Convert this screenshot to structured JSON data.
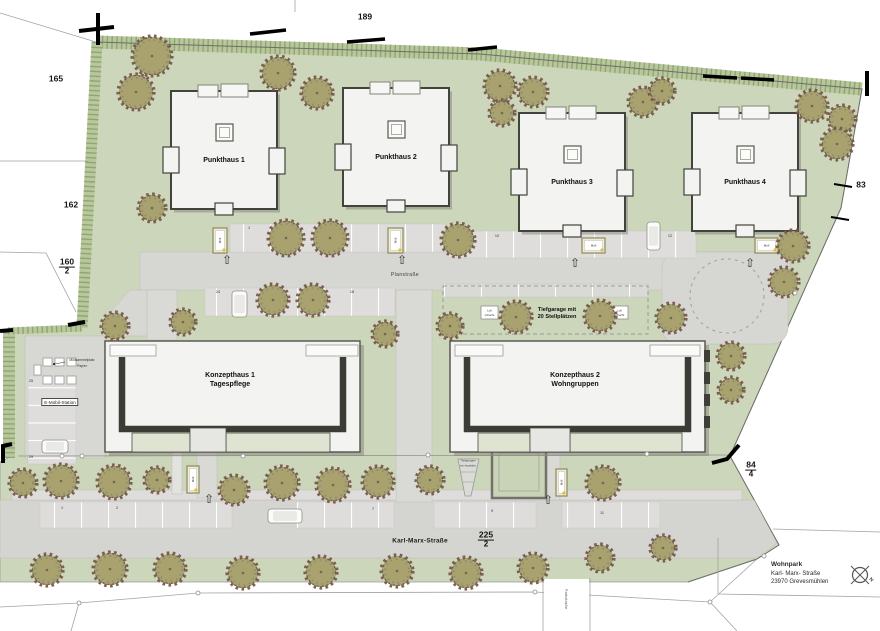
{
  "labels": {
    "planstrasse": "Planstraße",
    "karl_marx_strasse": "Karl-Marx-Straße",
    "side_street": "Parkstraße",
    "muell": "Müll",
    "compass_n": "N",
    "entrance_arrow": "⇧"
  },
  "buildings": {
    "punkthaus": [
      {
        "label": "Punkthaus 1",
        "x": 171,
        "y": 91
      },
      {
        "label": "Punkthaus 2",
        "x": 343,
        "y": 88
      },
      {
        "label": "Punkthaus 3",
        "x": 519,
        "y": 113
      },
      {
        "label": "Punkthaus 4",
        "x": 692,
        "y": 113
      }
    ],
    "konzepthaus": [
      {
        "label": "Konzepthaus 1",
        "subtitle": "Tagespflege"
      },
      {
        "label": "Konzepthaus 2",
        "subtitle": "Wohngruppen"
      }
    ]
  },
  "garage": {
    "line1": "Tiefgarage mit",
    "line2": "20 Stellplätzen",
    "shaft_line1": "Luft",
    "shaft_line2": "schacht",
    "ramp_line1": "Tiefgaragen",
    "ramp_line2": "ein-/ausfahrt"
  },
  "emobil": {
    "station": "E-Mobil-Station",
    "waste_line1": "Müllsammelplatz",
    "waste_line2": "Papier"
  },
  "address": {
    "name": "Wohnpark",
    "street": "Karl- Marx- Straße",
    "city": "23970 Grevesmühlen"
  },
  "parcels": [
    {
      "num": "189",
      "x": 365,
      "y": 17
    },
    {
      "num": "165",
      "x": 56,
      "y": 79
    },
    {
      "num": "162",
      "x": 71,
      "y": 205
    },
    {
      "num": "160",
      "den": "2",
      "x": 67,
      "y": 267
    },
    {
      "num": "83",
      "x": 861,
      "y": 185
    },
    {
      "num": "84",
      "den": "4",
      "x": 751,
      "y": 470
    },
    {
      "num": "225",
      "den": "2",
      "x": 486,
      "y": 540
    }
  ],
  "parking_numbers": [
    {
      "n": "1",
      "x": 249,
      "y": 228
    },
    {
      "n": "10",
      "x": 497,
      "y": 236
    },
    {
      "n": "12",
      "x": 670,
      "y": 236
    },
    {
      "n": "24",
      "x": 218,
      "y": 292
    },
    {
      "n": "18",
      "x": 352,
      "y": 292
    },
    {
      "n": "1",
      "x": 62,
      "y": 508
    },
    {
      "n": "2",
      "x": 117,
      "y": 508
    },
    {
      "n": "7",
      "x": 373,
      "y": 509
    },
    {
      "n": "9",
      "x": 492,
      "y": 511
    },
    {
      "n": "11",
      "x": 602,
      "y": 513
    },
    {
      "n": "25",
      "x": 31,
      "y": 381
    },
    {
      "n": "29",
      "x": 31,
      "y": 457
    }
  ],
  "colors": {
    "site_green": "#ccd6bb",
    "hedge_green": "#b9c79d",
    "hedge_hatch": "#90a573",
    "road_gray": "#d6d6d3",
    "bay_gray": "#dedddb",
    "building_fill": "#f3f3f1",
    "building_edge": "#43433d",
    "tree_fill": "#a9a26e",
    "tree_speckle": "#7d5549",
    "court_green": "#c9d3b6",
    "marker_black": "#000000"
  },
  "map": {
    "trees": [
      [
        152,
        56,
        19
      ],
      [
        136,
        92,
        17
      ],
      [
        278,
        73,
        16
      ],
      [
        317,
        93,
        15
      ],
      [
        500,
        86,
        15
      ],
      [
        533,
        92,
        14
      ],
      [
        502,
        113,
        12
      ],
      [
        643,
        102,
        14
      ],
      [
        662,
        91,
        12
      ],
      [
        812,
        106,
        15
      ],
      [
        842,
        119,
        13
      ],
      [
        837,
        144,
        15
      ],
      [
        152,
        208,
        13
      ],
      [
        115,
        326,
        13
      ],
      [
        183,
        322,
        12
      ],
      [
        286,
        238,
        17
      ],
      [
        330,
        238,
        17
      ],
      [
        458,
        240,
        16
      ],
      [
        793,
        246,
        15
      ],
      [
        273,
        300,
        15
      ],
      [
        313,
        300,
        15
      ],
      [
        385,
        334,
        12
      ],
      [
        450,
        326,
        12
      ],
      [
        516,
        317,
        15
      ],
      [
        600,
        316,
        15
      ],
      [
        671,
        318,
        14
      ],
      [
        731,
        356,
        13
      ],
      [
        731,
        390,
        12
      ],
      [
        784,
        282,
        14
      ],
      [
        603,
        483,
        16
      ],
      [
        23,
        483,
        13
      ],
      [
        61,
        481,
        16
      ],
      [
        114,
        482,
        16
      ],
      [
        157,
        480,
        12
      ],
      [
        234,
        490,
        14
      ],
      [
        282,
        483,
        16
      ],
      [
        333,
        485,
        16
      ],
      [
        378,
        482,
        15
      ],
      [
        430,
        480,
        13
      ],
      [
        47,
        570,
        15
      ],
      [
        110,
        569,
        16
      ],
      [
        170,
        569,
        15
      ],
      [
        243,
        573,
        15
      ],
      [
        321,
        572,
        15
      ],
      [
        397,
        571,
        15
      ],
      [
        466,
        573,
        15
      ],
      [
        533,
        568,
        14
      ],
      [
        600,
        558,
        13
      ],
      [
        663,
        548,
        12
      ]
    ],
    "cars": [
      {
        "x": 647,
        "y": 222,
        "w": 13,
        "h": 28
      },
      {
        "x": 232,
        "y": 291,
        "w": 15,
        "h": 26
      },
      {
        "x": 42,
        "y": 440,
        "w": 26,
        "h": 13
      },
      {
        "x": 268,
        "y": 509,
        "w": 34,
        "h": 14
      }
    ],
    "muell_boxes": [
      {
        "x": 213,
        "y": 228,
        "w": 14,
        "h": 25,
        "v": true
      },
      {
        "x": 388,
        "y": 228,
        "w": 15,
        "h": 25,
        "v": true
      },
      {
        "x": 582,
        "y": 238,
        "w": 23,
        "h": 15,
        "v": false
      },
      {
        "x": 755,
        "y": 238,
        "w": 23,
        "h": 15,
        "v": false
      },
      {
        "x": 187,
        "y": 466,
        "w": 12,
        "h": 27,
        "v": true
      },
      {
        "x": 556,
        "y": 469,
        "w": 11,
        "h": 27,
        "v": true
      }
    ],
    "arrows": [
      [
        227,
        260
      ],
      [
        402,
        260
      ],
      [
        575,
        263
      ],
      [
        750,
        263
      ],
      [
        209,
        499
      ],
      [
        548,
        500
      ]
    ],
    "shafts": [
      [
        481,
        306
      ],
      [
        611,
        306
      ]
    ],
    "containers": [
      [
        43,
        358,
        9,
        8
      ],
      [
        55,
        358,
        9,
        8
      ],
      [
        67,
        358,
        9,
        8
      ],
      [
        43,
        376,
        9,
        8
      ],
      [
        55,
        376,
        9,
        8
      ],
      [
        67,
        376,
        9,
        8
      ],
      [
        34,
        365,
        7,
        10
      ]
    ]
  }
}
